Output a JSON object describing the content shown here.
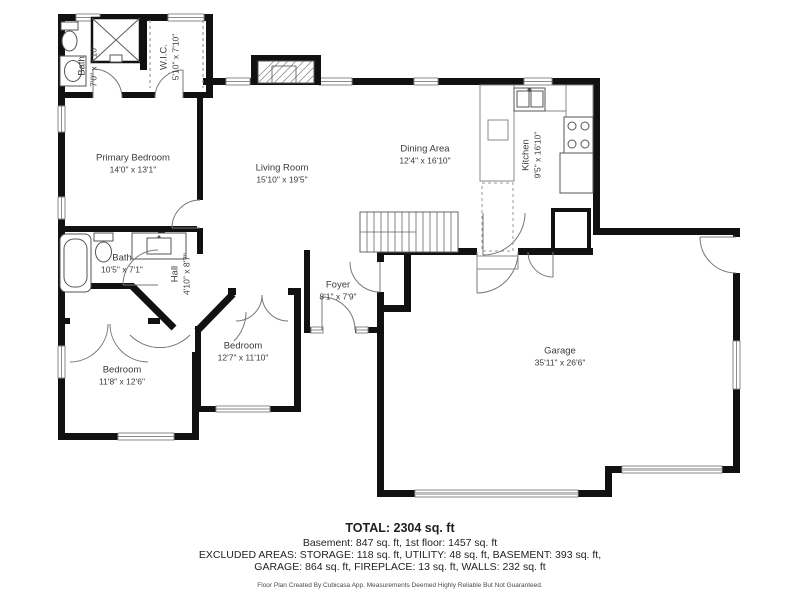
{
  "rooms": [
    {
      "id": "bath-upper",
      "name": "Bath",
      "dims": "7'0\" x 7'10\""
    },
    {
      "id": "wic",
      "name": "W.I.C.",
      "dims": "5'10\" x 7'10\""
    },
    {
      "id": "primary-bedroom",
      "name": "Primary Bedroom",
      "dims": "14'0\" x 13'1\""
    },
    {
      "id": "living-room",
      "name": "Living Room",
      "dims": "15'10\" x 19'5\""
    },
    {
      "id": "dining-area",
      "name": "Dining Area",
      "dims": "12'4\" x 16'10\""
    },
    {
      "id": "kitchen",
      "name": "Kitchen",
      "dims": "9'5\" x 16'10\""
    },
    {
      "id": "bath-lower",
      "name": "Bath",
      "dims": "10'5\" x 7'1\""
    },
    {
      "id": "hall",
      "name": "Hall",
      "dims": "4'10\" x 8'7\""
    },
    {
      "id": "bedroom-left",
      "name": "Bedroom",
      "dims": "11'8\" x 12'6\""
    },
    {
      "id": "bedroom-middle",
      "name": "Bedroom",
      "dims": "12'7\" x 11'10\""
    },
    {
      "id": "foyer",
      "name": "Foyer",
      "dims": "8'1\" x 7'9\""
    },
    {
      "id": "garage",
      "name": "Garage",
      "dims": "35'11\" x 26'6\""
    }
  ],
  "summary": {
    "total": "TOTAL: 2304 sq. ft",
    "floors": "Basement: 847 sq. ft, 1st floor: 1457 sq. ft",
    "excluded1": "EXCLUDED AREAS: STORAGE: 118 sq. ft, UTILITY: 48 sq. ft, BASEMENT: 393 sq. ft,",
    "excluded2": "GARAGE: 864 sq. ft, FIREPLACE: 13 sq. ft, WALLS: 232 sq. ft",
    "disclaimer": "Floor Plan Created By Cubicasa App. Measurements Deemed Highly Reliable But Not Guaranteed."
  },
  "colors": {
    "wall": "#111111",
    "window_line": "#8a8a8a",
    "door_arc": "#777777",
    "garage_door": "#bfbfbf",
    "label_text": "#3a3a3a"
  }
}
